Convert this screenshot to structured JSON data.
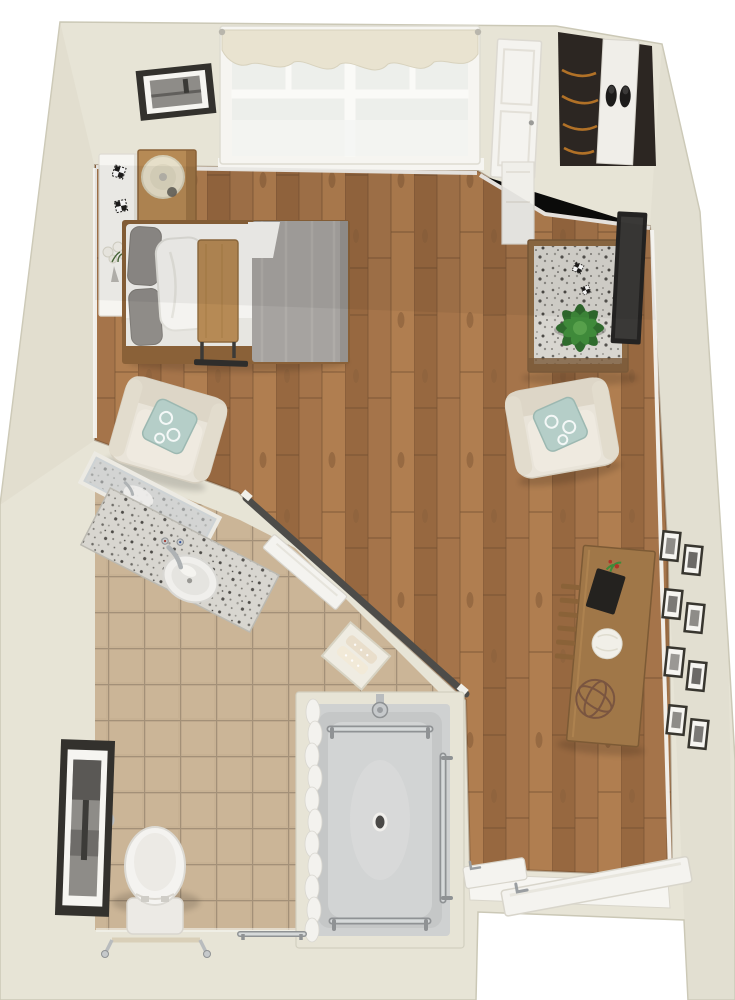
{
  "meta": {
    "title": "Top-down 3D floor plan — studio apartment with accessible bathroom",
    "view": "top-down render",
    "text_on_screen": "none"
  },
  "colors": {
    "bg": "#ffffff",
    "wall": "#e7e4d6",
    "wallShade": "#d9d5c4",
    "wallEdge": "#cbc8b6",
    "trim": "#f6f5f1",
    "wood1": "#a5744a",
    "wood2": "#976840",
    "wood3": "#b07e50",
    "woodLine": "#6f4c2e",
    "tile": "#c7b193",
    "grout": "#a39078",
    "graniteBase": "#d8d6d0",
    "white": "#f4f3f0",
    "chairCream": "#e9e4d9",
    "chairCreamDark": "#ddd6c7",
    "pillowTeal": "#b5cec8",
    "blanketGray": "#a6a3a0",
    "pillowGray": "#8f8c88",
    "furnWood": "#a07748",
    "furnWoodDark": "#7c5a35",
    "furnWoodLight": "#b68a55",
    "bedFrame": "#8a6138",
    "dark": "#2b2a28",
    "tv": "#242322",
    "plantGreen": "#3f8a3a",
    "plantGreenDark": "#2f6b2d",
    "plantGreenLight": "#57a04b",
    "chrome": "#c6c9cb",
    "chromeDark": "#8f9294",
    "showerPan": "#cfd1d1",
    "showerPanDark": "#c5c7c7",
    "curtain": "#f3f2ee",
    "closetDark": "#2c2622",
    "clothesOrange": "#c07a28",
    "railDark": "#4d4c49",
    "frameDark": "#33312d",
    "photoGray": "#8e8c88",
    "lampShade": "#e6dfc9",
    "doorWhite": "#f4f3ef"
  },
  "rooms": {
    "studio": {
      "label": "Studio living and sleeping area",
      "floor": "hardwood"
    },
    "bathroom": {
      "label": "Bathroom",
      "floor": "beige tile"
    },
    "closet": {
      "label": "Closet with hanging clothes and shoe shelf"
    },
    "entry": {
      "label": "Entry with open door"
    }
  },
  "objects": {
    "window": "Double window with cream scalloped valance",
    "wall_art_top": "Framed black and white photo on upper wall",
    "console": "White wall console with flowers and decor",
    "nightstand": "Wood nightstand with table lamp",
    "bed": "Twin bed, white linens, gray blanket, overbed table",
    "armchair_left": "Cream armchair with teal patterned pillow",
    "armchair_right": "Cream armchair with teal patterned pillow",
    "dresser": "Dresser with granite top and potted plant",
    "tv": "Wall-mounted flat screen TV",
    "closet_door": "White closet door",
    "desk": "Wood desk with chair, decor sphere and orb",
    "gallery": "Gallery of eight small framed photos",
    "vanity": "Granite vanity with round sink and mirror",
    "sliding_rail": "Dark sliding barn-door track on angled wall",
    "towel_niche": "Wall niche with folded towels",
    "shower": "Roll-in shower with grab bars, curtain and drain",
    "toilet": "Toilet with grab bar and safety frame",
    "bath_art": "Tall framed black and white art in bathroom",
    "entry_door": "Entry door swung open into the room"
  }
}
